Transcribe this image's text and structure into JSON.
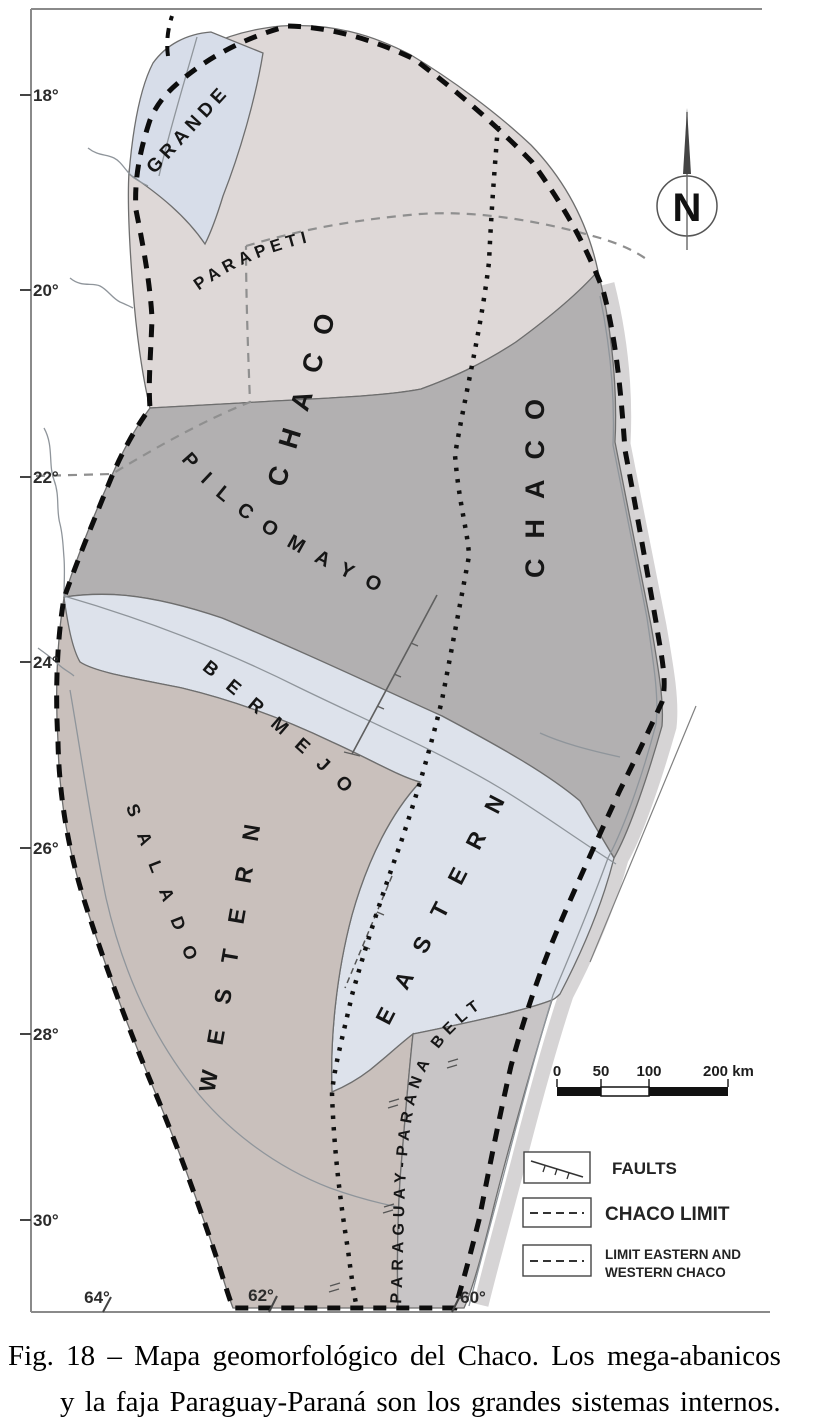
{
  "figure": {
    "caption_line1": "Fig. 18 – Mapa geomorfológico del Chaco. Los mega-abanicos",
    "caption_line2": "y la faja Paraguay-Paraná son los grandes sistemas internos."
  },
  "map": {
    "north_label": "N",
    "region_labels": {
      "grande": "GRANDE",
      "parapeti": "PARAPETI",
      "chaco_west": "CHACO",
      "chaco_east": "CHACO",
      "pilcomayo": "PILCOMAYO",
      "bermejo": "BERMEJO",
      "salado": "SALADO",
      "western": "WESTERN",
      "eastern": "EASTERN",
      "paraguay_parana_belt": "PARAGUAY-PARANA BELT"
    },
    "lat_ticks": [
      "18°",
      "20°",
      "22°",
      "24°",
      "26°",
      "28°",
      "30°"
    ],
    "lon_ticks": [
      "64°",
      "62°",
      "60°"
    ],
    "scale_bar": {
      "tick_labels": [
        "0",
        "50",
        "100"
      ],
      "end_label": "200 km"
    },
    "legend": {
      "faults": "FAULTS",
      "chaco_limit": "CHACO LIMIT",
      "ew_limit_line1": "LIMIT EASTERN AND",
      "ew_limit_line2": "WESTERN CHACO"
    },
    "colors": {
      "north_chaco": "#ded8d7",
      "grande_fan": "#d7dde9",
      "pilcomayo_dark": "#b2b0b1",
      "bermejo_eastern": "#dde2eb",
      "western_salado": "#c9c0bc",
      "parana_belt": "#c8c5c6",
      "east_strip": "#d6d4d5"
    }
  }
}
